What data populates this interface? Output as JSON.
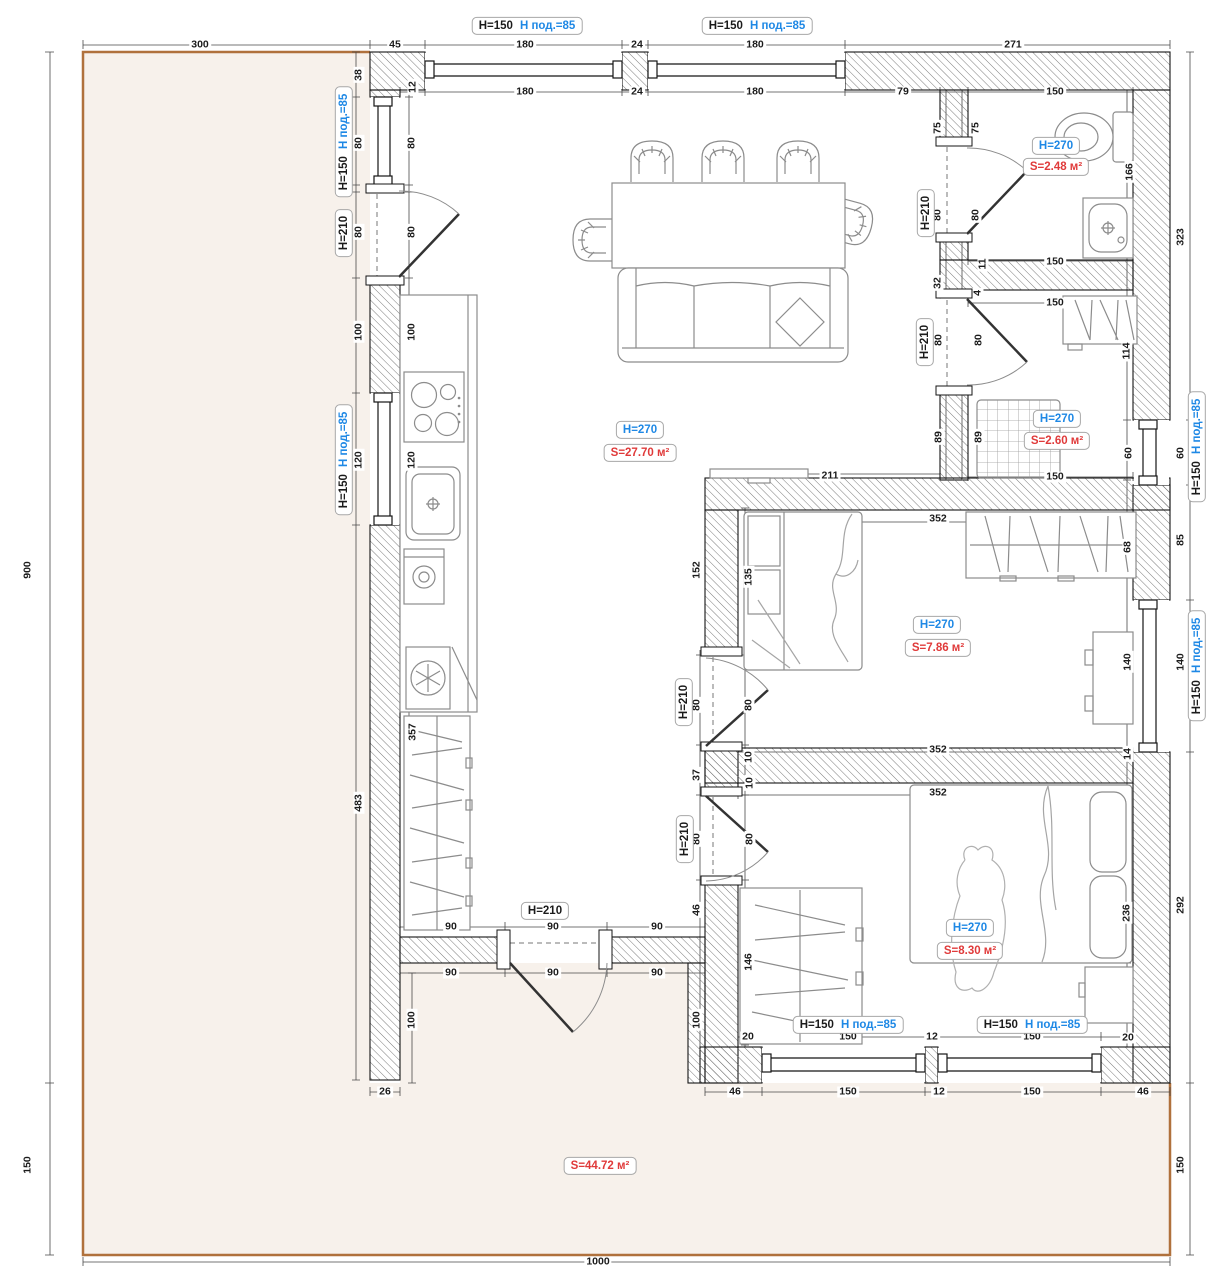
{
  "colors": {
    "accent_blue": "#1e88e5",
    "accent_red": "#e03a3a",
    "terrace_fill": "#f7f1eb",
    "terrace_border": "#b0713c",
    "wall_line": "#141414",
    "dim_text": "#1b1b1b"
  },
  "window_label": {
    "h": "H=150",
    "sill": "Н под.=85"
  },
  "door_label": "H=210",
  "rooms": [
    {
      "name": "living-kitchen",
      "height": "H=270",
      "area": "S=27.70 м²",
      "hx": 640,
      "hy": 430,
      "sx": 640,
      "sy": 453
    },
    {
      "name": "bathroom",
      "height": "H=270",
      "area": "S=2.48 м²",
      "hx": 1056,
      "hy": 146,
      "sx": 1056,
      "sy": 167
    },
    {
      "name": "laundry",
      "height": "H=270",
      "area": "S=2.60 м²",
      "hx": 1057,
      "hy": 419,
      "sx": 1057,
      "sy": 441
    },
    {
      "name": "bedroom-1",
      "height": "H=270",
      "area": "S=7.86 м²",
      "hx": 937,
      "hy": 625,
      "sx": 938,
      "sy": 648
    },
    {
      "name": "bedroom-2",
      "height": "H=270",
      "area": "S=8.30 м²",
      "hx": 970,
      "hy": 928,
      "sx": 970,
      "sy": 951
    },
    {
      "name": "terrace",
      "height": null,
      "area": "S=44.72 м²",
      "sx": 600,
      "sy": 1166
    }
  ],
  "window_labels": [
    {
      "x": 527,
      "y": 26,
      "v": 0
    },
    {
      "x": 757,
      "y": 26,
      "v": 0
    },
    {
      "x": 344,
      "y": 142,
      "v": 1
    },
    {
      "x": 344,
      "y": 460,
      "v": 1
    },
    {
      "x": 1197,
      "y": 447,
      "v": 1
    },
    {
      "x": 1197,
      "y": 666,
      "v": 1
    },
    {
      "x": 848,
      "y": 1025,
      "v": 0
    },
    {
      "x": 1032,
      "y": 1025,
      "v": 0
    }
  ],
  "door_labels": [
    {
      "x": 344,
      "y": 233,
      "v": 1
    },
    {
      "x": 926,
      "y": 213,
      "v": 1
    },
    {
      "x": 925,
      "y": 342,
      "v": 1
    },
    {
      "x": 684,
      "y": 702,
      "v": 1
    },
    {
      "x": 685,
      "y": 839,
      "v": 1
    },
    {
      "x": 545,
      "y": 911,
      "v": 0
    }
  ],
  "dims": [
    [
      "300",
      200,
      45,
      0
    ],
    [
      "45",
      395,
      45,
      0
    ],
    [
      "180",
      525,
      45,
      0
    ],
    [
      "24",
      637,
      45,
      0
    ],
    [
      "180",
      755,
      45,
      0
    ],
    [
      "271",
      1013,
      45,
      0
    ],
    [
      "12",
      413,
      87,
      1
    ],
    [
      "180",
      525,
      92,
      0
    ],
    [
      "24",
      637,
      92,
      0
    ],
    [
      "180",
      755,
      92,
      0
    ],
    [
      "79",
      903,
      92,
      0
    ],
    [
      "150",
      1055,
      92,
      0
    ],
    [
      "38",
      359,
      75,
      1
    ],
    [
      "80",
      359,
      143,
      1
    ],
    [
      "80",
      359,
      232,
      1
    ],
    [
      "100",
      359,
      332,
      1
    ],
    [
      "120",
      359,
      460,
      1
    ],
    [
      "483",
      359,
      803,
      1
    ],
    [
      "80",
      412,
      143,
      1
    ],
    [
      "80",
      412,
      232,
      1
    ],
    [
      "100",
      412,
      332,
      1
    ],
    [
      "120",
      412,
      460,
      1
    ],
    [
      "357",
      413,
      732,
      1
    ],
    [
      "900",
      28,
      570,
      1
    ],
    [
      "150",
      28,
      1165,
      1
    ],
    [
      "75",
      938,
      128,
      1
    ],
    [
      "75",
      976,
      128,
      1
    ],
    [
      "80",
      938,
      215,
      1
    ],
    [
      "80",
      976,
      215,
      1
    ],
    [
      "32",
      938,
      283,
      1
    ],
    [
      "11",
      983,
      264,
      1
    ],
    [
      "4",
      978,
      293,
      1
    ],
    [
      "166",
      1130,
      172,
      1
    ],
    [
      "150",
      1055,
      262,
      0
    ],
    [
      "150",
      1055,
      303,
      0
    ],
    [
      "80",
      939,
      340,
      1
    ],
    [
      "80",
      979,
      340,
      1
    ],
    [
      "89",
      939,
      437,
      1
    ],
    [
      "89",
      979,
      437,
      1
    ],
    [
      "114",
      1127,
      351,
      1
    ],
    [
      "60",
      1129,
      453,
      1
    ],
    [
      "150",
      1055,
      477,
      0
    ],
    [
      "323",
      1181,
      237,
      1
    ],
    [
      "60",
      1181,
      453,
      1
    ],
    [
      "85",
      1181,
      540,
      1
    ],
    [
      "140",
      1181,
      662,
      1
    ],
    [
      "292",
      1181,
      905,
      1
    ],
    [
      "150",
      1181,
      1165,
      1
    ],
    [
      "211",
      830,
      476,
      0
    ],
    [
      "352",
      938,
      519,
      0
    ],
    [
      "152",
      697,
      570,
      1
    ],
    [
      "135",
      749,
      577,
      1
    ],
    [
      "68",
      1128,
      547,
      1
    ],
    [
      "140",
      1128,
      662,
      1
    ],
    [
      "14",
      1128,
      754,
      1
    ],
    [
      "352",
      938,
      750,
      0
    ],
    [
      "80",
      697,
      705,
      1
    ],
    [
      "80",
      749,
      705,
      1
    ],
    [
      "10",
      749,
      757,
      1
    ],
    [
      "37",
      697,
      775,
      1
    ],
    [
      "352",
      938,
      793,
      0
    ],
    [
      "10",
      750,
      783,
      1
    ],
    [
      "80",
      697,
      839,
      1
    ],
    [
      "80",
      750,
      839,
      1
    ],
    [
      "46",
      697,
      910,
      1
    ],
    [
      "146",
      749,
      962,
      1
    ],
    [
      "236",
      1127,
      913,
      1
    ],
    [
      "90",
      451,
      927,
      0
    ],
    [
      "90",
      553,
      927,
      0
    ],
    [
      "90",
      657,
      927,
      0
    ],
    [
      "90",
      451,
      973,
      0
    ],
    [
      "90",
      553,
      973,
      0
    ],
    [
      "90",
      657,
      973,
      0
    ],
    [
      "100",
      412,
      1020,
      1
    ],
    [
      "100",
      697,
      1020,
      1
    ],
    [
      "26",
      385,
      1092,
      0
    ],
    [
      "20",
      748,
      1037,
      0
    ],
    [
      "150",
      848,
      1037,
      0
    ],
    [
      "12",
      932,
      1037,
      0
    ],
    [
      "150",
      1032,
      1037,
      0
    ],
    [
      "20",
      1128,
      1038,
      0
    ],
    [
      "46",
      735,
      1092,
      0
    ],
    [
      "150",
      848,
      1092,
      0
    ],
    [
      "12",
      939,
      1092,
      0
    ],
    [
      "150",
      1032,
      1092,
      0
    ],
    [
      "46",
      1143,
      1092,
      0
    ],
    [
      "1000",
      598,
      1262,
      0
    ]
  ]
}
